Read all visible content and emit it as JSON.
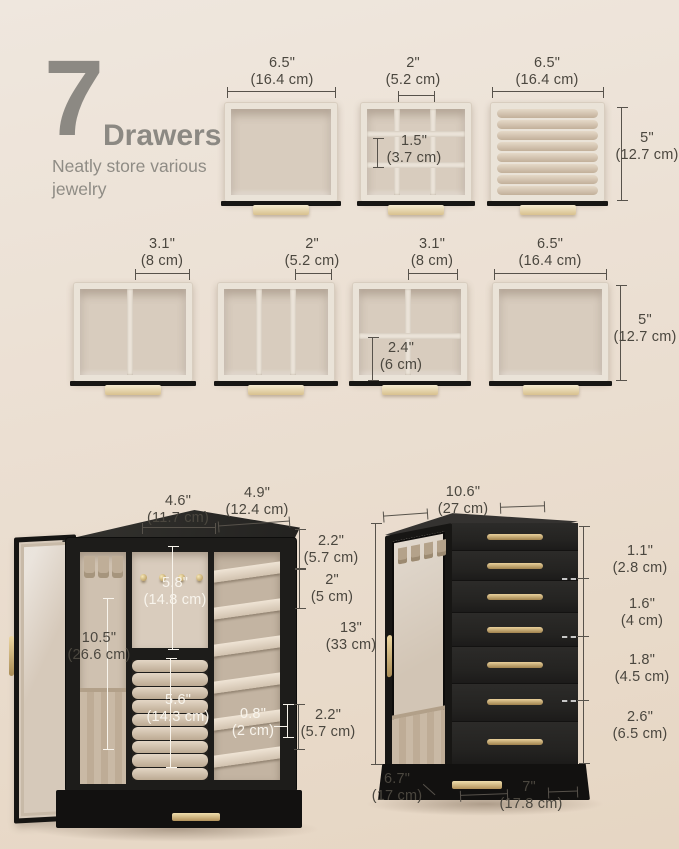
{
  "header": {
    "number": "7",
    "title": "Drawers",
    "subtitle_line1": "Neatly store various",
    "subtitle_line2": "jewelry"
  },
  "row1": {
    "open_drawer": {
      "width_in": "6.5\"",
      "width_cm": "(16.4 cm)"
    },
    "grid_drawer": {
      "cell_in": "2\"",
      "cell_cm": "(5.2 cm)",
      "cell_h_in": "1.5\"",
      "cell_h_cm": "(3.7 cm)"
    },
    "ring_drawer": {
      "width_in": "6.5\"",
      "width_cm": "(16.4 cm)",
      "depth_in": "5\"",
      "depth_cm": "(12.7 cm)"
    }
  },
  "row2": {
    "two_comp": {
      "cell_in": "3.1\"",
      "cell_cm": "(8 cm)"
    },
    "three_comp": {
      "cell_in": "2\"",
      "cell_cm": "(5.2 cm)"
    },
    "four_comp": {
      "cell_in": "3.1\"",
      "cell_cm": "(8 cm)",
      "cell_h_in": "2.4\"",
      "cell_h_cm": "(6 cm)"
    },
    "open_drawer": {
      "width_in": "6.5\"",
      "width_cm": "(16.4 cm)",
      "depth_in": "5\"",
      "depth_cm": "(12.7 cm)"
    }
  },
  "open_cabinet": {
    "top_left_in": "4.6\"",
    "top_left_cm": "(11.7 cm)",
    "top_right_in": "4.9\"",
    "top_right_cm": "(12.4 cm)",
    "shelf_top_in": "2.2\"",
    "shelf_top_cm": "(5.7 cm)",
    "shelf_gap_in": "2\"",
    "shelf_gap_cm": "(5 cm)",
    "panel_in": "5.8\"",
    "panel_cm": "(14.8 cm)",
    "door_in": "10.5\"",
    "door_cm": "(26.6 cm)",
    "rolls_in": "5.6\"",
    "rolls_cm": "(14.3 cm)",
    "slot_in": "0.8\"",
    "slot_cm": "(2 cm)",
    "base_in": "2.2\"",
    "base_cm": "(5.7 cm)"
  },
  "closed_cabinet": {
    "width_top_in": "10.6\"",
    "width_top_cm": "(27 cm)",
    "height_in": "13\"",
    "height_cm": "(33 cm)",
    "drawer_small_in": "1.1\"",
    "drawer_small_cm": "(2.8 cm)",
    "drawer_mid_in": "1.6\"",
    "drawer_mid_cm": "(4 cm)",
    "drawer_large_in": "1.8\"",
    "drawer_large_cm": "(4.5 cm)",
    "drawer_xl_in": "2.6\"",
    "drawer_xl_cm": "(6.5 cm)",
    "depth_in": "6.7\"",
    "depth_cm": "(17 cm)",
    "width_bottom_in": "7\"",
    "width_bottom_cm": "(17.8 cm)"
  },
  "colors": {
    "background": "#ebdfd2",
    "cabinet_black": "#1d1c1a",
    "velvet": "#d8ccbe",
    "gold": "#c9ab72",
    "text_dark": "#4b473f",
    "text_gray": "#8c8983",
    "line_white": "#f8f4ec"
  }
}
